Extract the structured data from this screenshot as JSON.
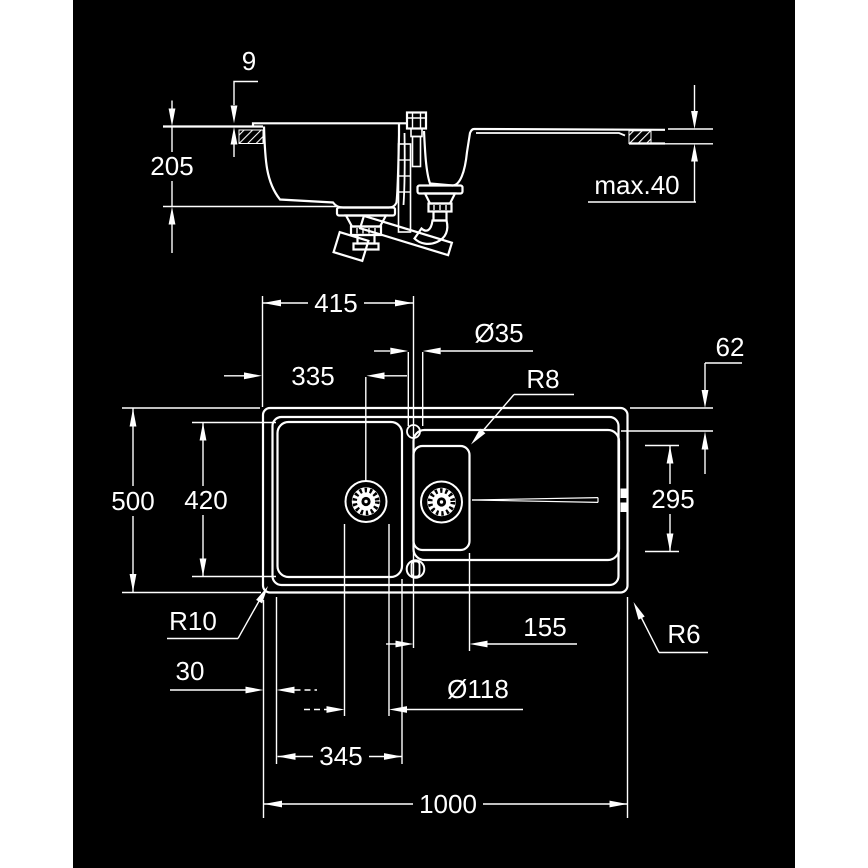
{
  "meta": {
    "type": "technical-dimension-drawing",
    "subject": "kitchen sink with one-and-half bowls and drainboard",
    "views": [
      {
        "id": "section",
        "name": "front section view",
        "dimension_labels": [
          "9",
          "205",
          "max.40"
        ]
      },
      {
        "id": "plan",
        "name": "top plan view",
        "dimension_labels": [
          "415",
          "Ø35",
          "62",
          "335",
          "R8",
          "500",
          "420",
          "295",
          "R10",
          "155",
          "R6",
          "30",
          "Ø118",
          "345",
          "1000"
        ]
      }
    ]
  },
  "colors": {
    "page_background": "#ffffff",
    "canvas_background": "#000000",
    "line": "#ffffff"
  },
  "dims": {
    "rim_height": "9",
    "bowl_depth": "205",
    "counter_max": "max.40",
    "faucet_from_left": "415",
    "faucet_hole_dia": "Ø35",
    "edge_to_board": "62",
    "drain_from_left": "335",
    "board_corner_radius": "R8",
    "overall_depth": "500",
    "bowl_depth_plan": "420",
    "board_width": "295",
    "front_left_radius": "R10",
    "faucet_to_half_bowl": "155",
    "front_right_radius": "R6",
    "rim_width": "30",
    "drain_dia": "Ø118",
    "bowl_width": "345",
    "overall_width": "1000"
  }
}
